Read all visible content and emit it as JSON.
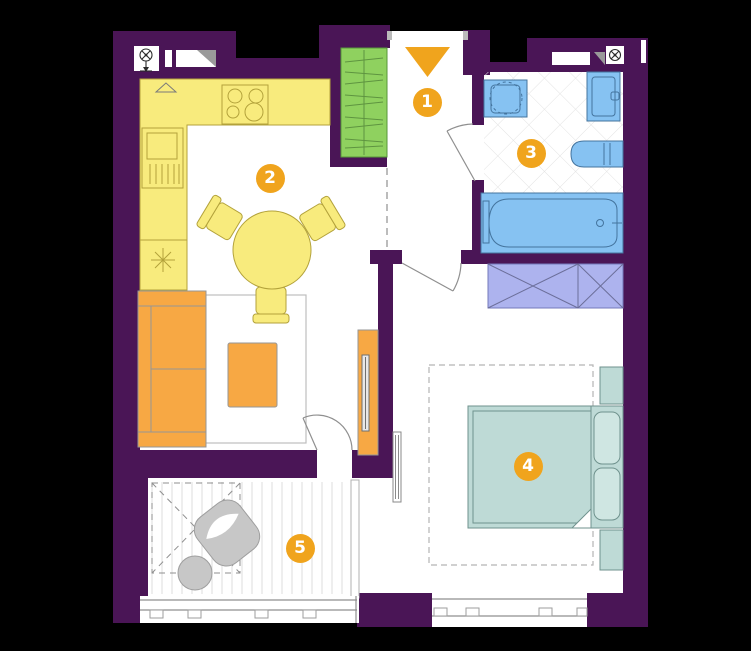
{
  "canvas": {
    "width": 751,
    "height": 651
  },
  "rooms": [
    {
      "number": "1"
    },
    {
      "number": "2"
    },
    {
      "number": "3"
    },
    {
      "number": "4"
    },
    {
      "number": "5"
    }
  ],
  "colors": {
    "background": "#000000",
    "walls": "#4a1556",
    "floor": "#ffffff",
    "kitchen": "#f8eb7d",
    "soft": "#f7a844",
    "wardrobe": "#8fd15f",
    "sanitary": "#86c2f2",
    "bed": "#bedad6",
    "closet": "#adb3ee",
    "badge": "#f0a41d"
  }
}
